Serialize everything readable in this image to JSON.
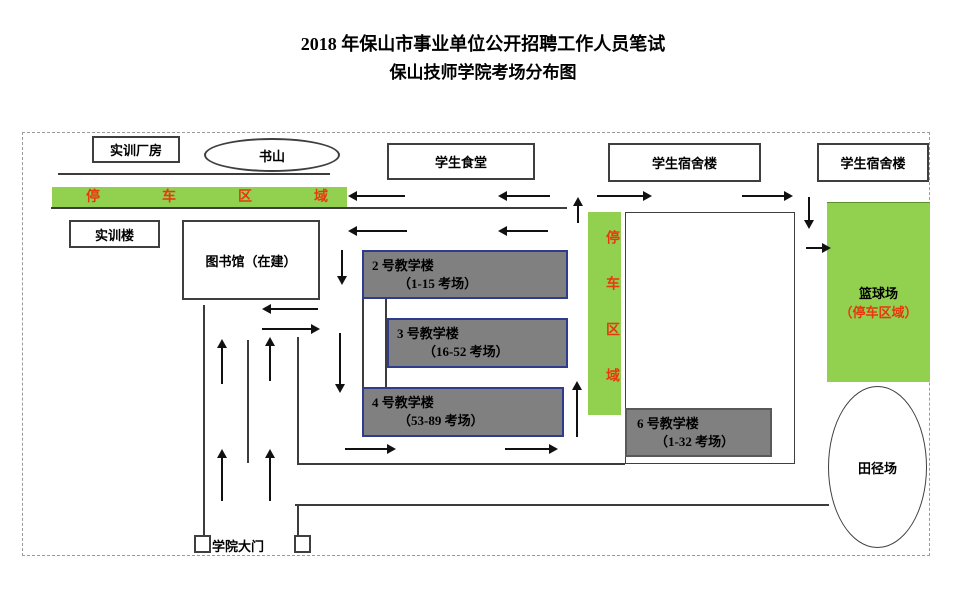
{
  "title": {
    "line1": "2018 年保山市事业单位公开招聘工作人员笔试",
    "line2": "保山技师学院考场分布图"
  },
  "buildings": {
    "training_workshop": "实训厂房",
    "book_hill": "书山",
    "canteen": "学生食堂",
    "dorm1": "学生宿舍楼",
    "dorm2": "学生宿舍楼",
    "training_building": "实训楼",
    "library": "图书馆（在建）",
    "building2": {
      "name": "2 号教学楼",
      "rooms": "（1-15 考场）"
    },
    "building3": {
      "name": "3 号教学楼",
      "rooms": "（16-52 考场）"
    },
    "building4": {
      "name": "4 号教学楼",
      "rooms": "（53-89 考场）"
    },
    "building6": {
      "name": "6 号教学楼",
      "rooms": "（1-32 考场）"
    },
    "parking_top": "停车区域",
    "parking_side": "停车区域",
    "basketball": {
      "name": "篮球场",
      "note": "（停车区域）"
    },
    "track_field": "田径场",
    "gate": "学院大门"
  },
  "colors": {
    "parking_green": "#92D050",
    "building_gray": "#808080",
    "red_text": "#E8380D",
    "blue_border": "#2F3C8E"
  },
  "graphics": {
    "lines": [
      [
        58,
        174,
        272,
        "h"
      ],
      [
        51,
        208,
        516,
        "h"
      ],
      [
        298,
        464,
        327,
        "h"
      ],
      [
        295,
        505,
        534,
        "h"
      ],
      [
        204,
        305,
        230,
        "v"
      ],
      [
        248,
        340,
        123,
        "v"
      ],
      [
        298,
        337,
        128,
        "v"
      ],
      [
        298,
        505,
        30,
        "v"
      ],
      [
        363,
        299,
        88,
        "v"
      ],
      [
        386,
        299,
        88,
        "v"
      ]
    ],
    "arrows": [
      [
        405,
        196,
        348,
        196
      ],
      [
        550,
        196,
        498,
        196
      ],
      [
        578,
        223,
        578,
        197
      ],
      [
        597,
        196,
        652,
        196
      ],
      [
        742,
        196,
        793,
        196
      ],
      [
        809,
        197,
        809,
        229
      ],
      [
        806,
        248,
        831,
        248
      ],
      [
        407,
        231,
        348,
        231
      ],
      [
        548,
        231,
        498,
        231
      ],
      [
        342,
        250,
        342,
        285
      ],
      [
        340,
        333,
        340,
        393
      ],
      [
        318,
        309,
        262,
        309
      ],
      [
        262,
        329,
        320,
        329
      ],
      [
        222,
        384,
        222,
        339
      ],
      [
        270,
        381,
        270,
        337
      ],
      [
        222,
        501,
        222,
        449
      ],
      [
        270,
        501,
        270,
        449
      ],
      [
        577,
        437,
        577,
        381
      ],
      [
        345,
        449,
        396,
        449
      ],
      [
        505,
        449,
        558,
        449
      ]
    ]
  }
}
